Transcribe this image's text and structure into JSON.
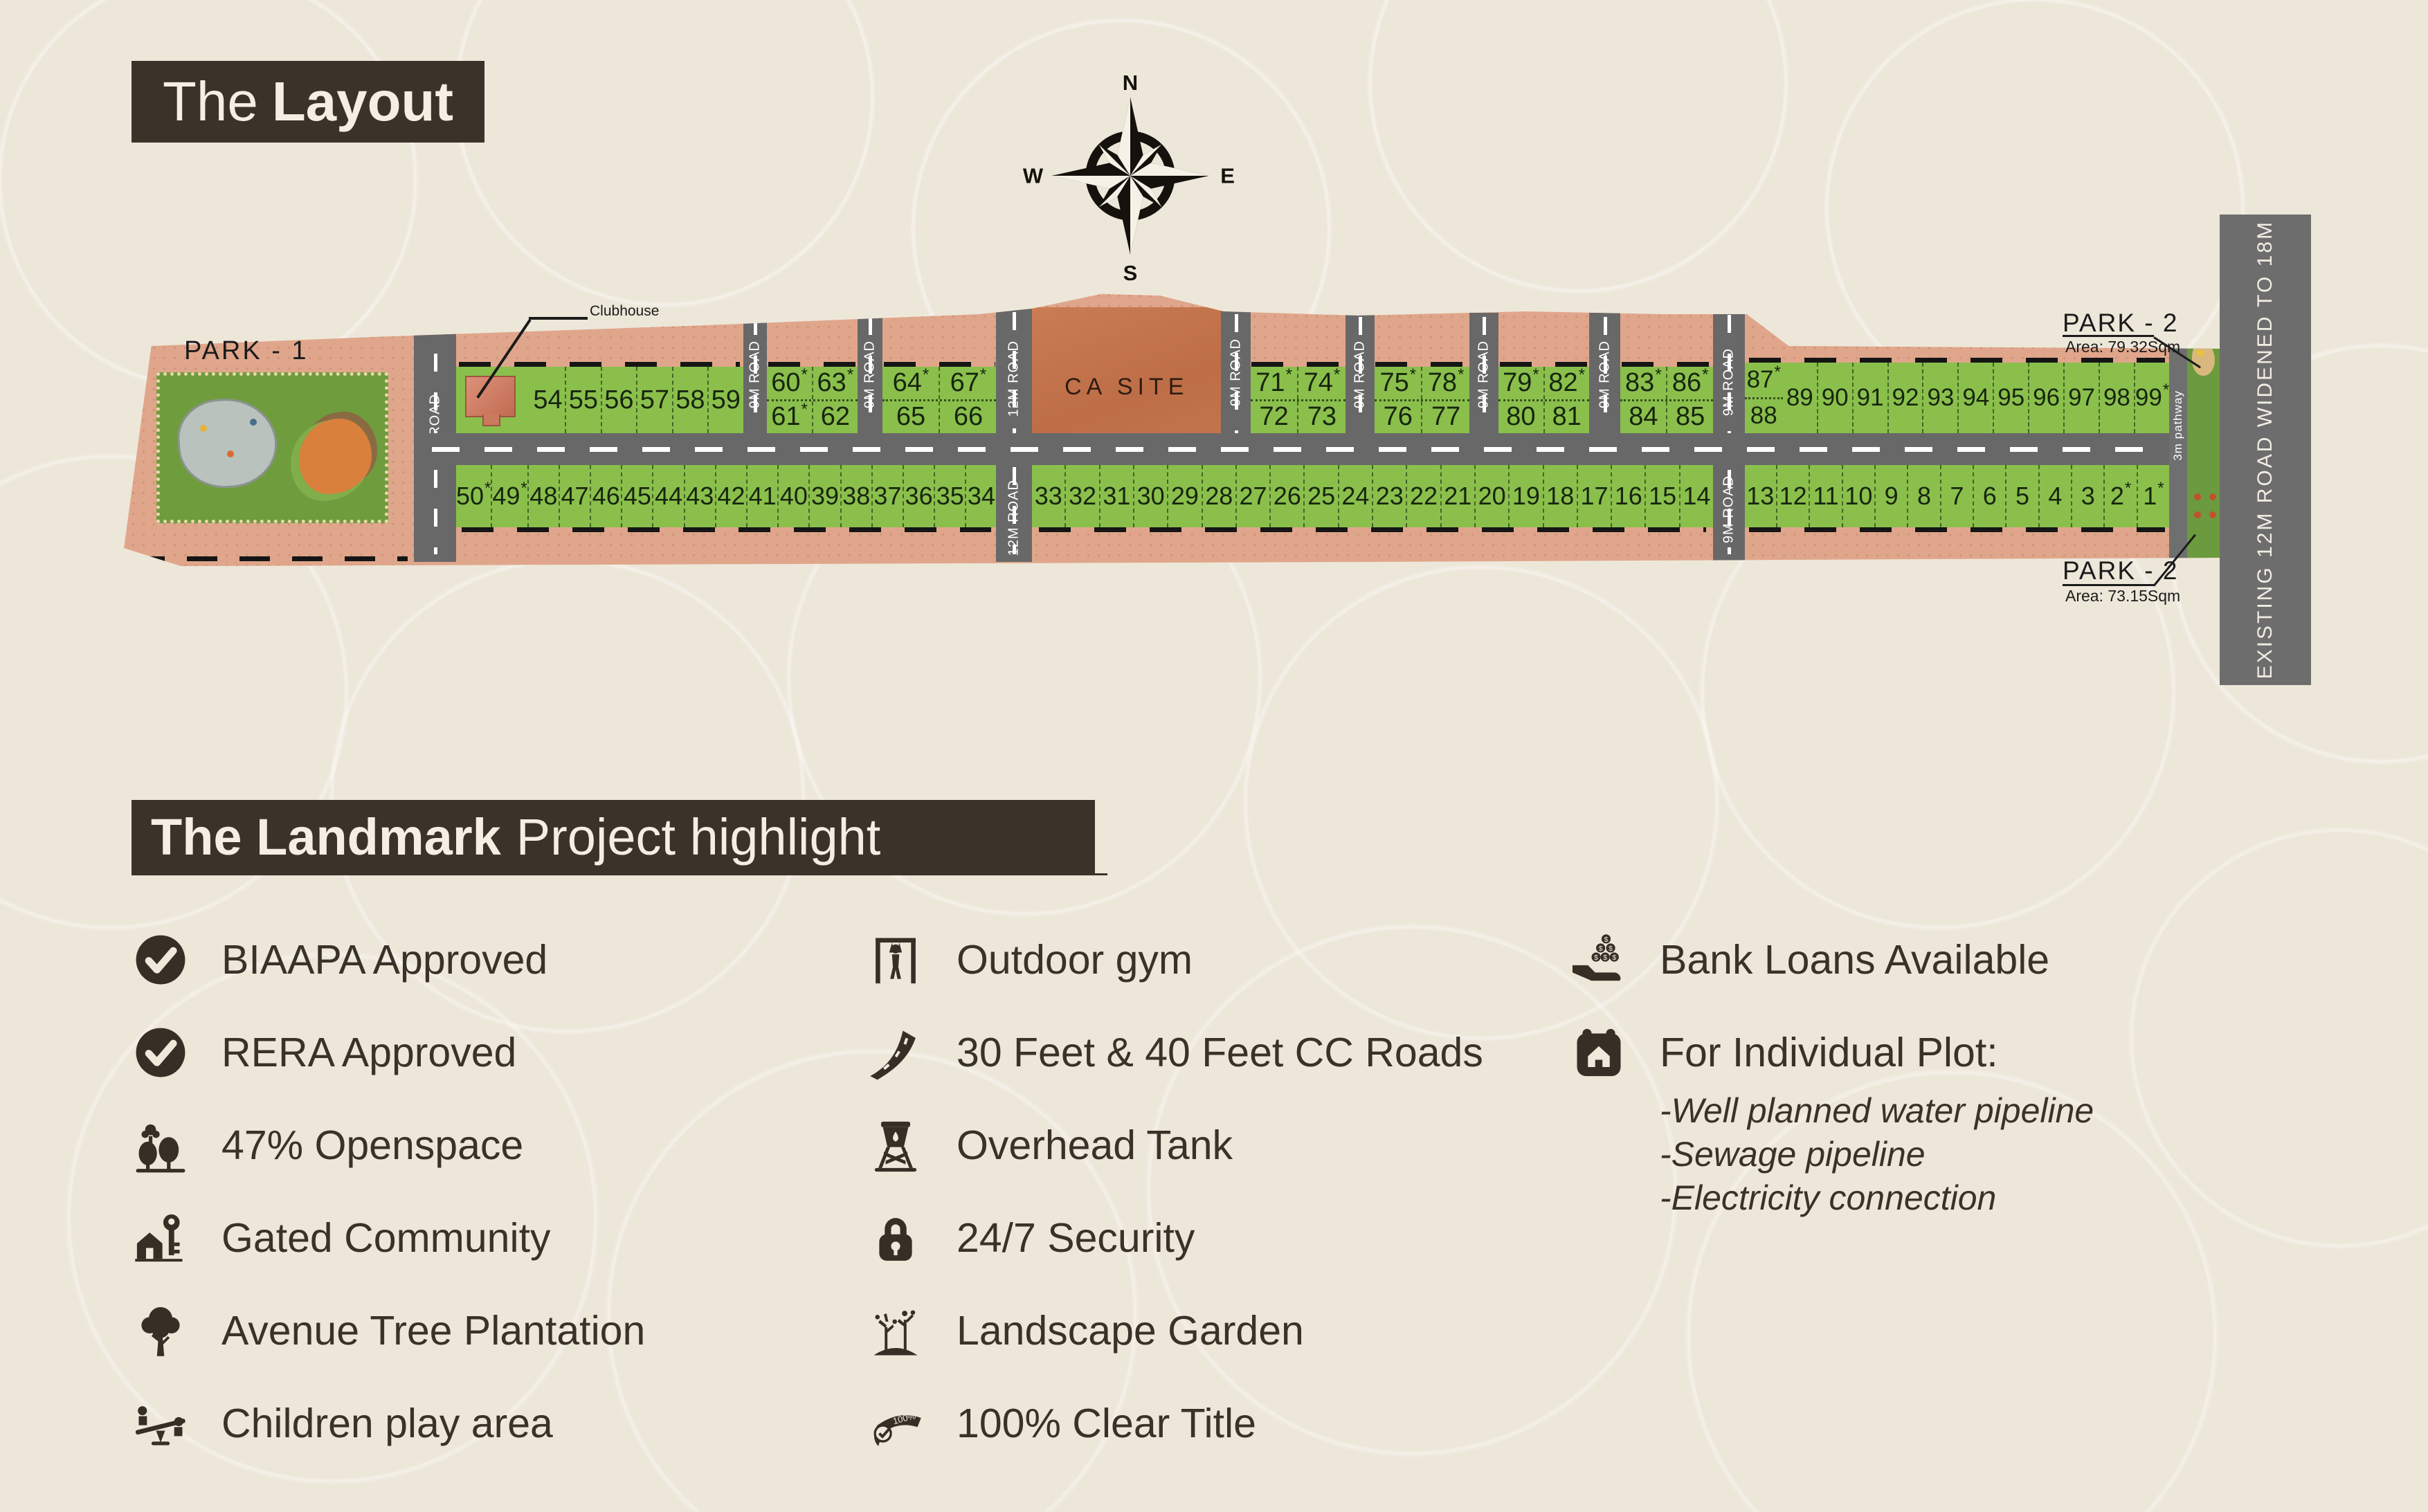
{
  "layout_title": {
    "light": "The",
    "bold": "Layout"
  },
  "compass": {
    "n": "N",
    "e": "E",
    "s": "S",
    "w": "W"
  },
  "map": {
    "park1": {
      "label": "PARK - 1"
    },
    "clubhouse": {
      "label": "Clubhouse"
    },
    "ca_site": {
      "label": "CA SITE"
    },
    "park2_top": {
      "label": "PARK - 2",
      "area": "Area: 79.32Sqm"
    },
    "park2_bottom": {
      "label": "PARK - 2",
      "area": "Area: 73.15Sqm"
    },
    "pathway": {
      "label": "3m pathway"
    },
    "existing_road": {
      "label": "EXISTING 12M ROAD WIDENED TO 18M"
    },
    "road_labels": {
      "nine": "9M ROAD",
      "twelve": "12M ROAD"
    },
    "top_row_a": [
      "54",
      "55",
      "56",
      "57",
      "58",
      "59"
    ],
    "grids": [
      [
        [
          "60*",
          "63*"
        ],
        [
          "61*",
          "62"
        ]
      ],
      [
        [
          "64*",
          "67*"
        ],
        [
          "65",
          "66"
        ]
      ],
      [
        [
          "71*",
          "74*"
        ],
        [
          "72",
          "73"
        ]
      ],
      [
        [
          "75*",
          "78*"
        ],
        [
          "76",
          "77"
        ]
      ],
      [
        [
          "79*",
          "82*"
        ],
        [
          "80",
          "81"
        ]
      ],
      [
        [
          "83*",
          "86*"
        ],
        [
          "84",
          "85"
        ]
      ]
    ],
    "top_right": {
      "first": [
        "87*",
        "88"
      ],
      "rest": [
        "89",
        "90",
        "91",
        "92",
        "93",
        "94",
        "95",
        "96",
        "97",
        "98",
        "99*"
      ]
    },
    "bottom_plots": {
      "seg1": [
        "50*",
        "49*",
        "48",
        "47",
        "46",
        "45",
        "44",
        "43",
        "42",
        "41",
        "40",
        "39",
        "38",
        "37",
        "36",
        "35",
        "34"
      ],
      "seg2": [
        "33",
        "32",
        "31",
        "30",
        "29",
        "28",
        "27",
        "26",
        "25",
        "24",
        "23",
        "22",
        "21",
        "20",
        "19",
        "18",
        "17",
        "16",
        "15",
        "14"
      ],
      "seg3": [
        "13",
        "12",
        "11",
        "10",
        "9",
        "8",
        "7",
        "6",
        "5",
        "4",
        "3",
        "2*",
        "1*"
      ]
    }
  },
  "highlight": {
    "title": {
      "bold": "The Landmark",
      "light": "Project highlight"
    },
    "col1": [
      {
        "icon": "check-badge",
        "label": "BIAAPA Approved"
      },
      {
        "icon": "check-badge",
        "label": "RERA Approved"
      },
      {
        "icon": "openspace-trees",
        "label": "47% Openspace"
      },
      {
        "icon": "gated-community",
        "label": "Gated Community"
      },
      {
        "icon": "avenue-tree",
        "label": "Avenue Tree Plantation"
      },
      {
        "icon": "children-play",
        "label": "Children play area"
      }
    ],
    "col2": [
      {
        "icon": "outdoor-gym",
        "label": "Outdoor gym"
      },
      {
        "icon": "cc-roads",
        "label": "30 Feet & 40 Feet CC Roads"
      },
      {
        "icon": "overhead-tank",
        "label": "Overhead Tank"
      },
      {
        "icon": "security-lock",
        "label": "24/7 Security"
      },
      {
        "icon": "landscape-garden",
        "label": "Landscape Garden"
      },
      {
        "icon": "clear-title",
        "label": "100% Clear Title"
      }
    ],
    "col3": [
      {
        "icon": "bank-loans",
        "label": "Bank Loans Available"
      },
      {
        "icon": "individual-plot",
        "label": "For Individual Plot:",
        "sub": [
          "-Well planned water pipeline",
          "-Sewage pipeline",
          "-Electricity connection"
        ]
      }
    ]
  }
}
